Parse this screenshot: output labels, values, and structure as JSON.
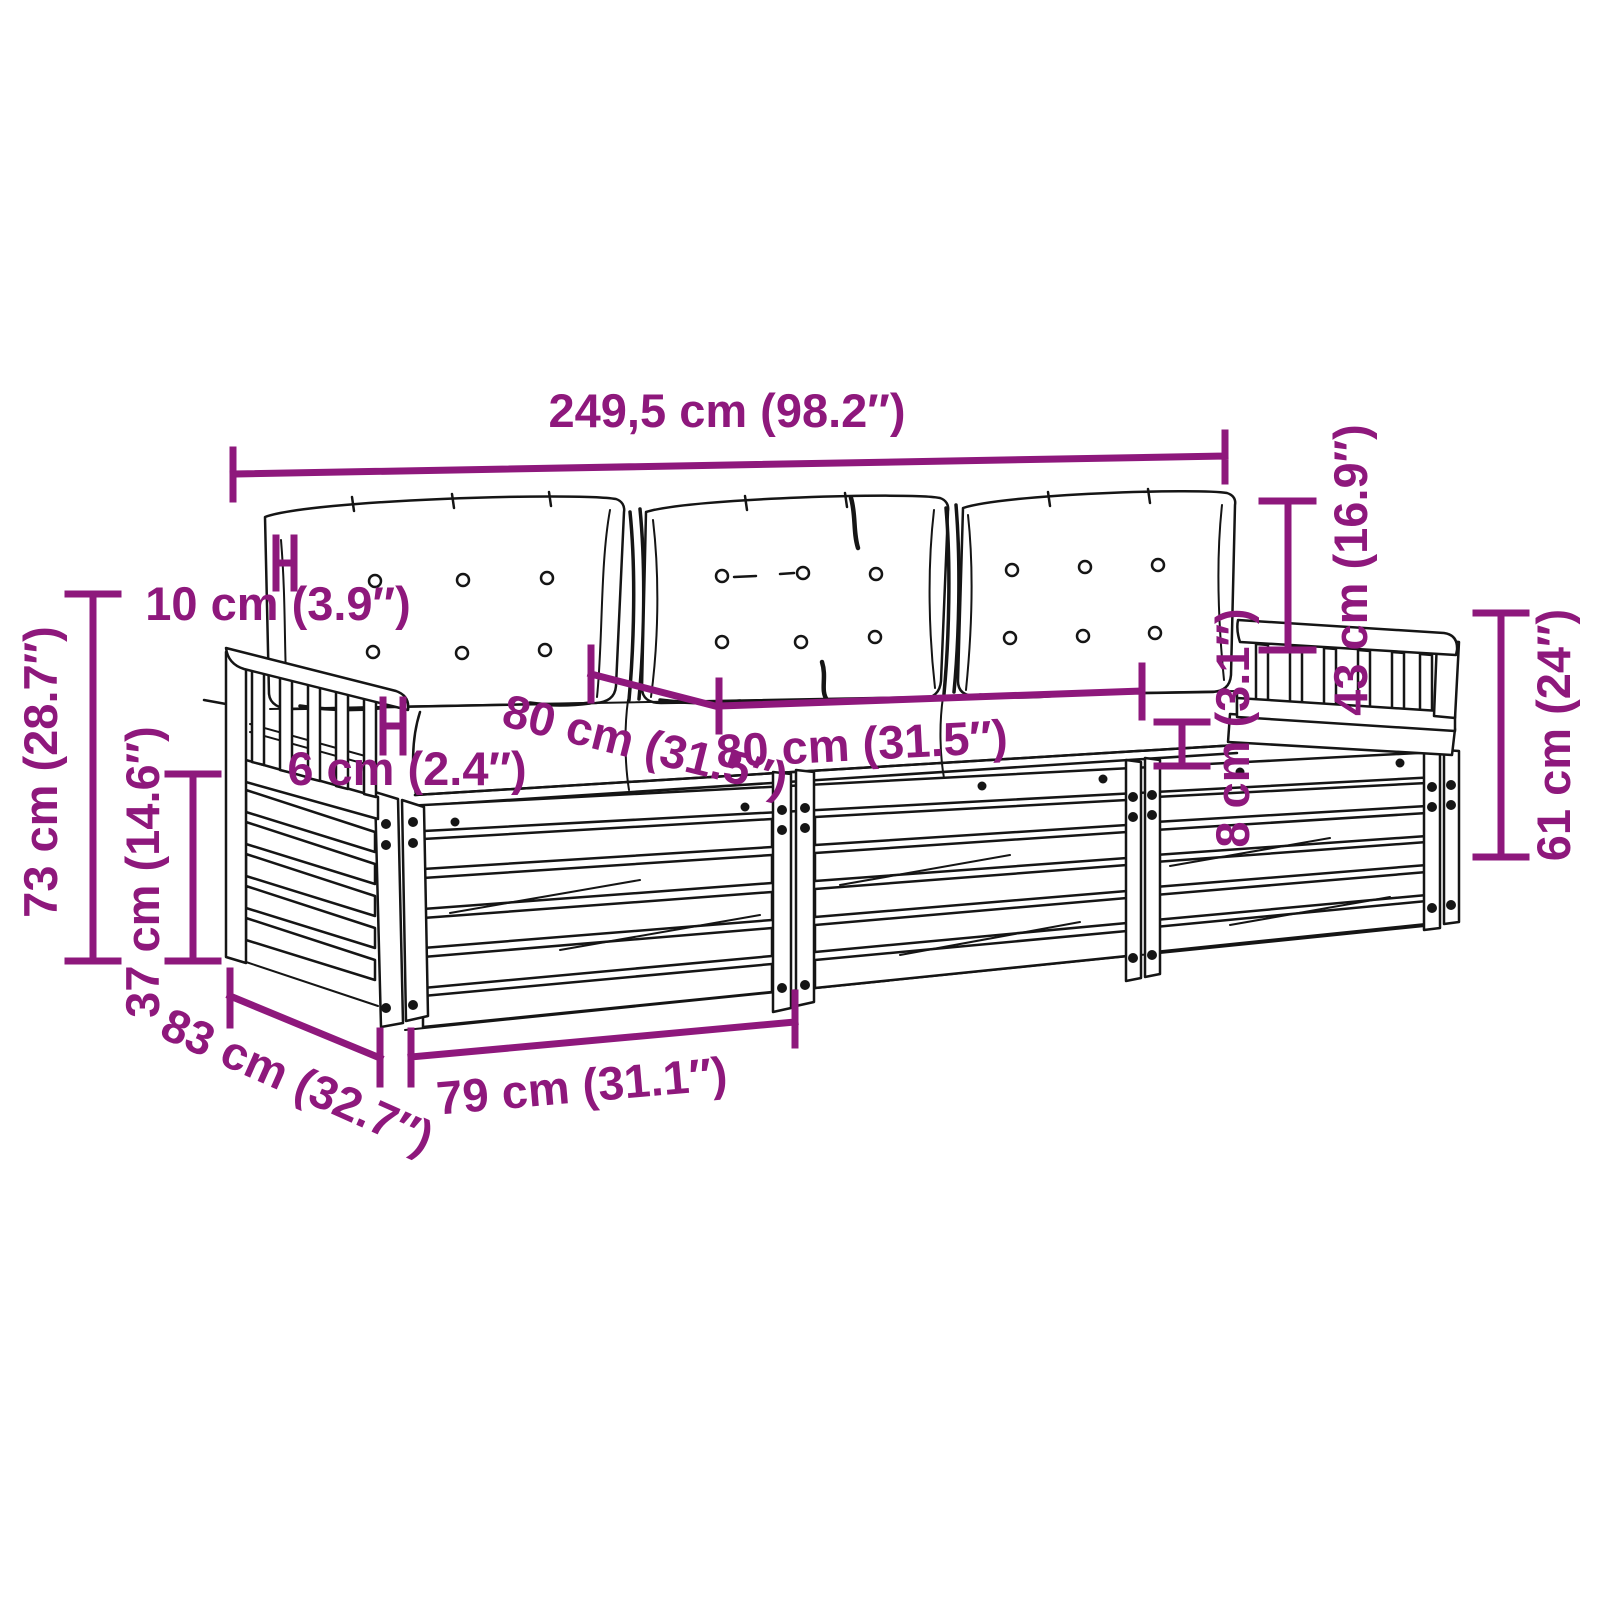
{
  "diagram": {
    "colors": {
      "dimension_accent": "#8E187C",
      "line_art": "#151515",
      "background": "#FFFFFF"
    },
    "dimensions": {
      "total_width": "249,5 cm (98.2″)",
      "back_height": "73 cm (28.7″)",
      "base_height": "37 cm (14.6″)",
      "back_cushion_thickness": "10 cm (3.9″)",
      "seat_cushion_thickness": "6 cm (2.4″)",
      "seat_width_left": "80 cm (31.5″)",
      "seat_width_right": "80 cm (31.5″)",
      "armrest_gap_height": "8 cm (3.1″)",
      "armrest_height": "43 cm (16.9″)",
      "right_side_height": "61 cm (24″)",
      "depth": "83 cm (32.7″)",
      "module_width": "79 cm (31.1″)"
    }
  }
}
